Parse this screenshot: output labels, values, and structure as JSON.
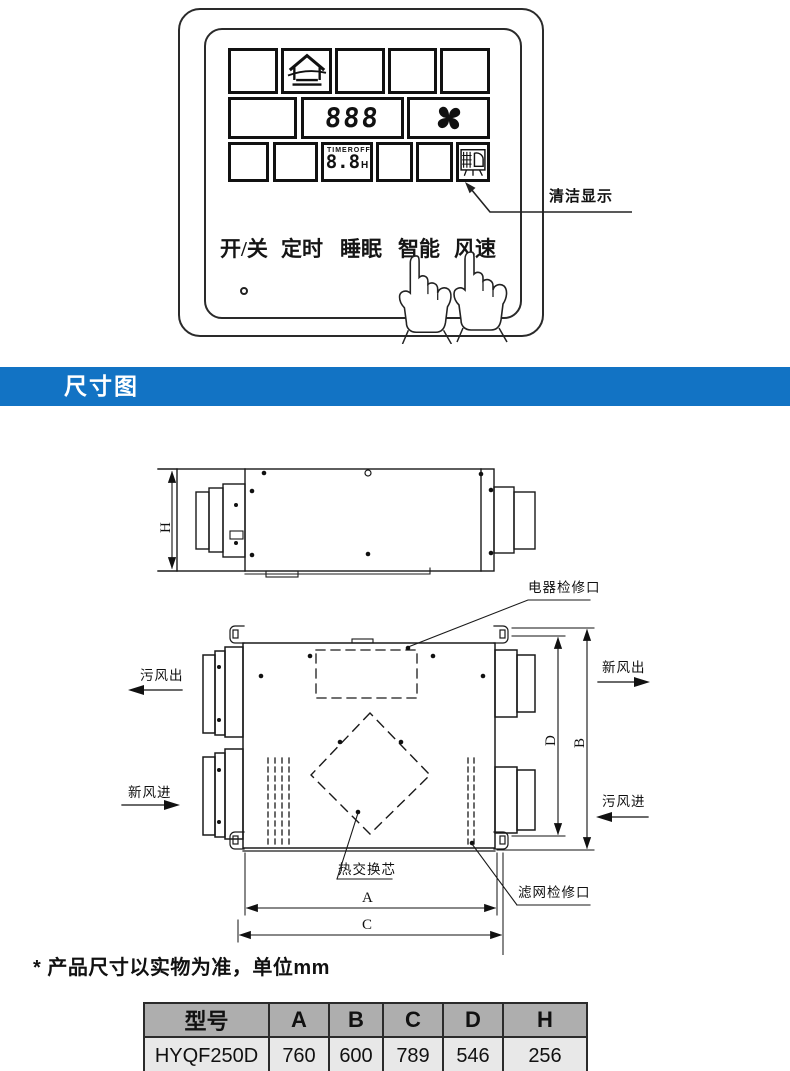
{
  "control_panel": {
    "display": {
      "main_value": "888",
      "timer_label": "TIMER",
      "timer_state": "OFF",
      "timer_value": "8.8",
      "timer_unit": "H"
    },
    "clean_annotation": "清洁显示",
    "buttons": [
      "开/关",
      "定时",
      "睡眠",
      "智能",
      "风速"
    ]
  },
  "banner": {
    "title": "尺寸图",
    "color": "#1273c4"
  },
  "diagram": {
    "labels": {
      "electric_access": "电器检修口",
      "foul_air_out": "污风出",
      "fresh_air_out": "新风出",
      "fresh_air_in": "新风进",
      "foul_air_in": "污风进",
      "heat_core": "热交换芯",
      "filter_access": "滤网检修口"
    },
    "dims": {
      "h": "H",
      "d": "D",
      "b": "B",
      "a": "A",
      "c": "C"
    }
  },
  "note": "* 产品尺寸以实物为准，单位mm",
  "spec_table": {
    "headers": [
      "型号",
      "A",
      "B",
      "C",
      "D",
      "H"
    ],
    "rows": [
      [
        "HYQF250D",
        "760",
        "600",
        "789",
        "546",
        "256"
      ]
    ]
  }
}
